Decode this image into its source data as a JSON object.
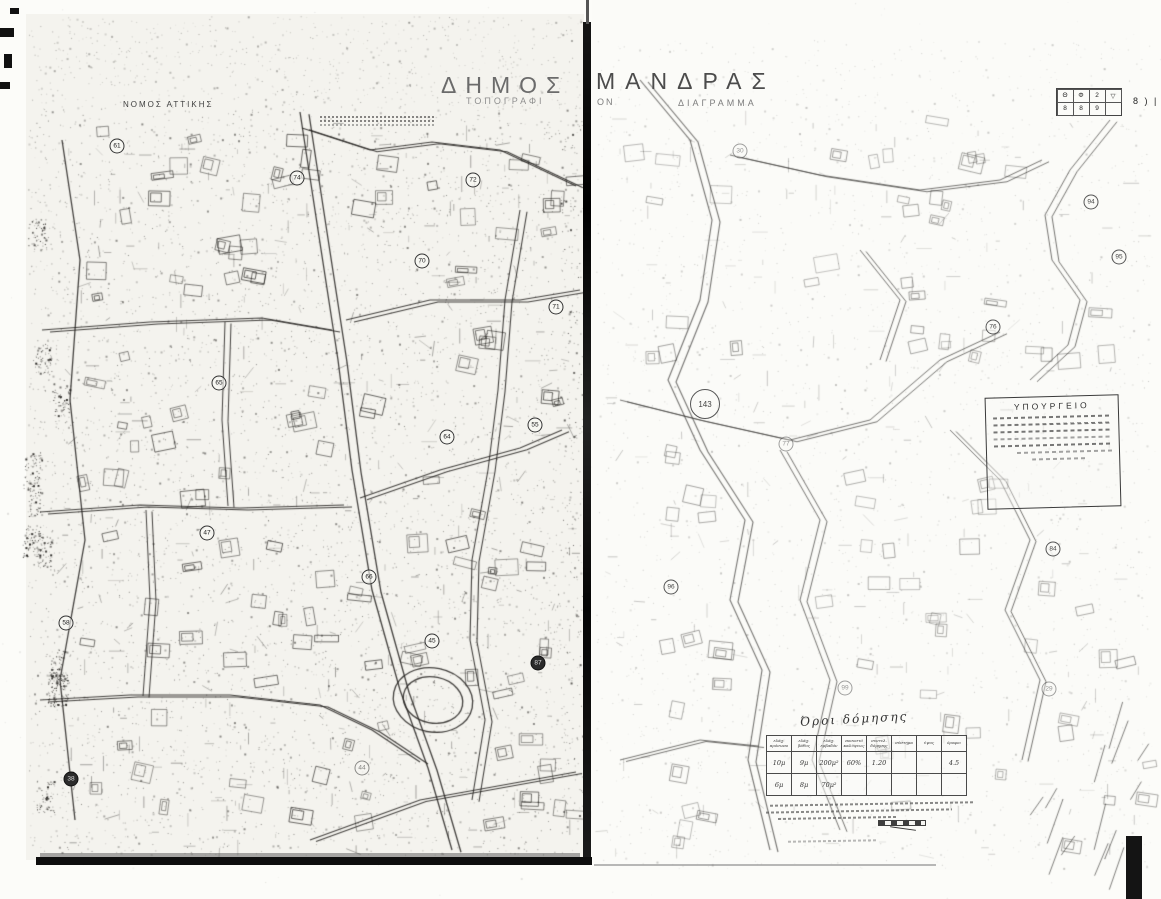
{
  "document": {
    "region_label": "ΝΟΜΟΣ ΑΤΤΙΚΗΣ",
    "title_left": "ΔΗΜΟΣ",
    "title_right": "ΜΑΝΔΡΑΣ",
    "subtitle_left_fragment": "ΤΟΠΟΓΡΑΦΙ",
    "subtitle_right_fragment": "ΟΝ",
    "subtitle_word2": "ΔΙΑΓΡΑΜΜΑ"
  },
  "stamp": {
    "title": "ΥΠΟΥΡΓΕΙΟ"
  },
  "corner_legend": {
    "row1": [
      "Θ",
      "Φ",
      "2",
      "▽"
    ],
    "row2": [
      "8",
      "8",
      "9"
    ],
    "side_marks": "8 ) |"
  },
  "building_terms_table": {
    "title": "Όροι δόμησης",
    "headers": [
      "ελάχ. πρόσωπο",
      "ελάχ. βάθος",
      "ελάχ. εμβαδόν",
      "ποσοστό καλύψεως",
      "συντελ. δόμησης",
      "σύστημα",
      "ύψος",
      "όροφοι"
    ],
    "rows": [
      [
        "10μ",
        "9μ",
        "200μ²",
        "60%",
        "1.20",
        "",
        "",
        "4.5"
      ],
      [
        "6μ",
        "8μ",
        "70μ²",
        "",
        "",
        "",
        "",
        ""
      ]
    ]
  },
  "map": {
    "left_blocks": [
      {
        "x": 117,
        "y": 146,
        "label": "61"
      },
      {
        "x": 297,
        "y": 178,
        "label": "74"
      },
      {
        "x": 473,
        "y": 180,
        "label": "72"
      },
      {
        "x": 422,
        "y": 261,
        "label": "70"
      },
      {
        "x": 556,
        "y": 307,
        "label": "71"
      },
      {
        "x": 219,
        "y": 383,
        "label": "65"
      },
      {
        "x": 447,
        "y": 437,
        "label": "64"
      },
      {
        "x": 535,
        "y": 425,
        "label": "55"
      },
      {
        "x": 207,
        "y": 533,
        "label": "47"
      },
      {
        "x": 369,
        "y": 577,
        "label": "66"
      },
      {
        "x": 66,
        "y": 623,
        "label": "58"
      },
      {
        "x": 432,
        "y": 641,
        "label": "45"
      },
      {
        "x": 538,
        "y": 663,
        "label": "87",
        "filled": true
      },
      {
        "x": 362,
        "y": 768,
        "label": "44",
        "faint": true
      },
      {
        "x": 71,
        "y": 779,
        "label": "38",
        "filled": true
      }
    ],
    "right_blocks": [
      {
        "x": 740,
        "y": 151,
        "label": "30",
        "faint": true
      },
      {
        "x": 1091,
        "y": 202,
        "label": "94"
      },
      {
        "x": 1119,
        "y": 257,
        "label": "95"
      },
      {
        "x": 993,
        "y": 327,
        "label": "76"
      },
      {
        "x": 705,
        "y": 404,
        "label": "143",
        "big": true
      },
      {
        "x": 786,
        "y": 444,
        "label": "77",
        "faint": true
      },
      {
        "x": 671,
        "y": 587,
        "label": "96"
      },
      {
        "x": 1053,
        "y": 549,
        "label": "84"
      },
      {
        "x": 1049,
        "y": 689,
        "label": "29",
        "faint": true
      },
      {
        "x": 845,
        "y": 688,
        "label": "99",
        "faint": true
      }
    ]
  }
}
